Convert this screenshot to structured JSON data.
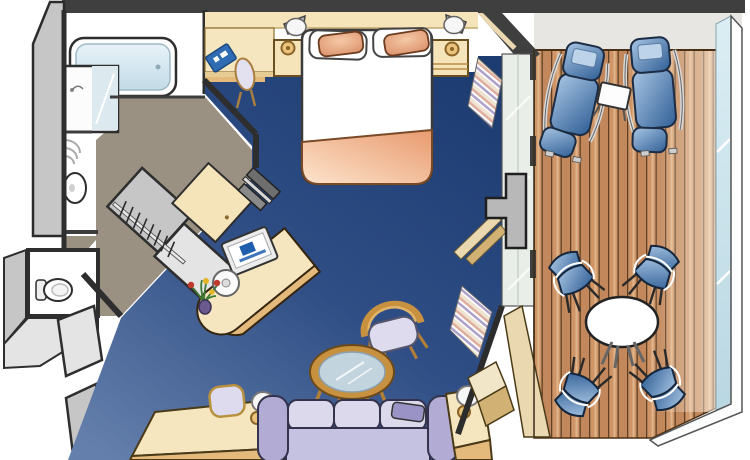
{
  "meta": {
    "scene": "cruise-suite-stateroom-floor-plan",
    "view": "overhead-illustration"
  },
  "colors": {
    "white": "#ffffff",
    "outline": "#2e2e2e",
    "wallDark": "#3f3f3f",
    "wallGraySide": "#c6c6c6",
    "wallGrayLight": "#e4e4e4",
    "floorTaupe": "#9a9183",
    "tubBlueA": "#e8f3f8",
    "tubBlueB": "#c2dbe7",
    "mirrorBlue": "#dce9ef",
    "carpetDark": "#1d3c72",
    "carpetMid": "#2f4e85",
    "carpetLight": "#647fab",
    "cabinetTan": "#f5e3ba",
    "cabinetTanLight": "#f6e6c0",
    "cabinetTanDark": "#e6cb92",
    "counterFace": "#e3b97c",
    "woodTrim": "#b98e44",
    "blanketDark": "#e89a6f",
    "blanketLight": "#fde4cc",
    "pillowPeachD": "#d98f68",
    "pillowPeachL": "#f6c8a6",
    "bookBlue": "#2f6cb4",
    "tvDark": "#6e6e6e",
    "tvMid": "#8a8a8a",
    "tvLight": "#d9d9d9",
    "tvLogoBlue": "#1f5fae",
    "sofaLilac": "#c5c1e1",
    "sofaLilacLight": "#dcd9ec",
    "sofaLilacDark": "#b2acd4",
    "throwLilac": "#9a94c6",
    "woodChair": "#c8913f",
    "woodChairDark": "#8a5f20",
    "glassTable": "#c2d4de",
    "chairBlueL": "#a9c6e4",
    "chairBlueD": "#2f5e95",
    "loungerPanel": "#bdd3ea",
    "deckA": "#cf9566",
    "deckB": "#c2875a",
    "deckLine": "#5f4026",
    "deckStreak": "#e0b58c",
    "balconyGray": "#e8e6e3",
    "railGlassA": "#dceef4",
    "railGlassB": "#b9d7e2",
    "glassDoor": "#e9eee8",
    "curtainCream": "#efe3d1",
    "curtainPink": "#dfae9f",
    "curtainLavender": "#ada1c9",
    "pelmetTan": "#ead9b0",
    "pelmetTanDark": "#d2b174",
    "mullionGray": "#b8b8b8",
    "lampGold": "#e9c27c",
    "lampGoldDark": "#8a6326",
    "lampShade": "#f6f6f6",
    "lampGray": "#b9b9b9",
    "stepCream": "#f2e6c8"
  },
  "scene": {
    "areas": [
      {
        "name": "bathroom",
        "floor": "white-tile",
        "fixtures": [
          "bathtub",
          "vanity-with-mirror-sink",
          "towel-shelf",
          "pedestal-sink",
          "toilet"
        ]
      },
      {
        "name": "entry-corridor",
        "floor": "taupe",
        "fixtures": [
          "entry-door-leaves",
          "wardrobe-closet",
          "hanger-rod"
        ]
      },
      {
        "name": "bedroom-sitting-area",
        "floor": "blue-carpet",
        "fixtures": [
          "queen-bed",
          "pillow-left",
          "pillow-right",
          "foot-blanket",
          "nightstand-left",
          "nightstand-right",
          "wall-lamp-left",
          "wall-lamp-right",
          "headboard-cabinetry",
          "blue-info-book",
          "vanity-chair",
          "desk-unit",
          "flat-tv-panels",
          "tv-with-logo",
          "stool",
          "flower-vase",
          "armchair",
          "glass-coffee-table",
          "sofa",
          "throw-pillow",
          "dressing-bench",
          "bench-chair",
          "table-lamp-left",
          "table-lamp-right",
          "side-table"
        ]
      },
      {
        "name": "window-wall",
        "fixtures": [
          "striped-curtains",
          "tan-pelmets",
          "glass-door",
          "gray-mullion",
          "threshold-steps"
        ]
      },
      {
        "name": "balcony",
        "floor": "teak-deck-planks",
        "fixtures": [
          "sun-lounger-1",
          "sun-lounger-2",
          "lounger-side-table",
          "round-dining-table",
          "balcony-chair-1",
          "balcony-chair-2",
          "balcony-chair-3",
          "balcony-chair-4",
          "glass-railing"
        ]
      }
    ],
    "counts": {
      "balcony_chairs": 4,
      "sun_loungers": 2,
      "bed_pillows": 2,
      "wall_lamps": 2,
      "table_lamps": 2,
      "tv_screens": 2
    }
  }
}
